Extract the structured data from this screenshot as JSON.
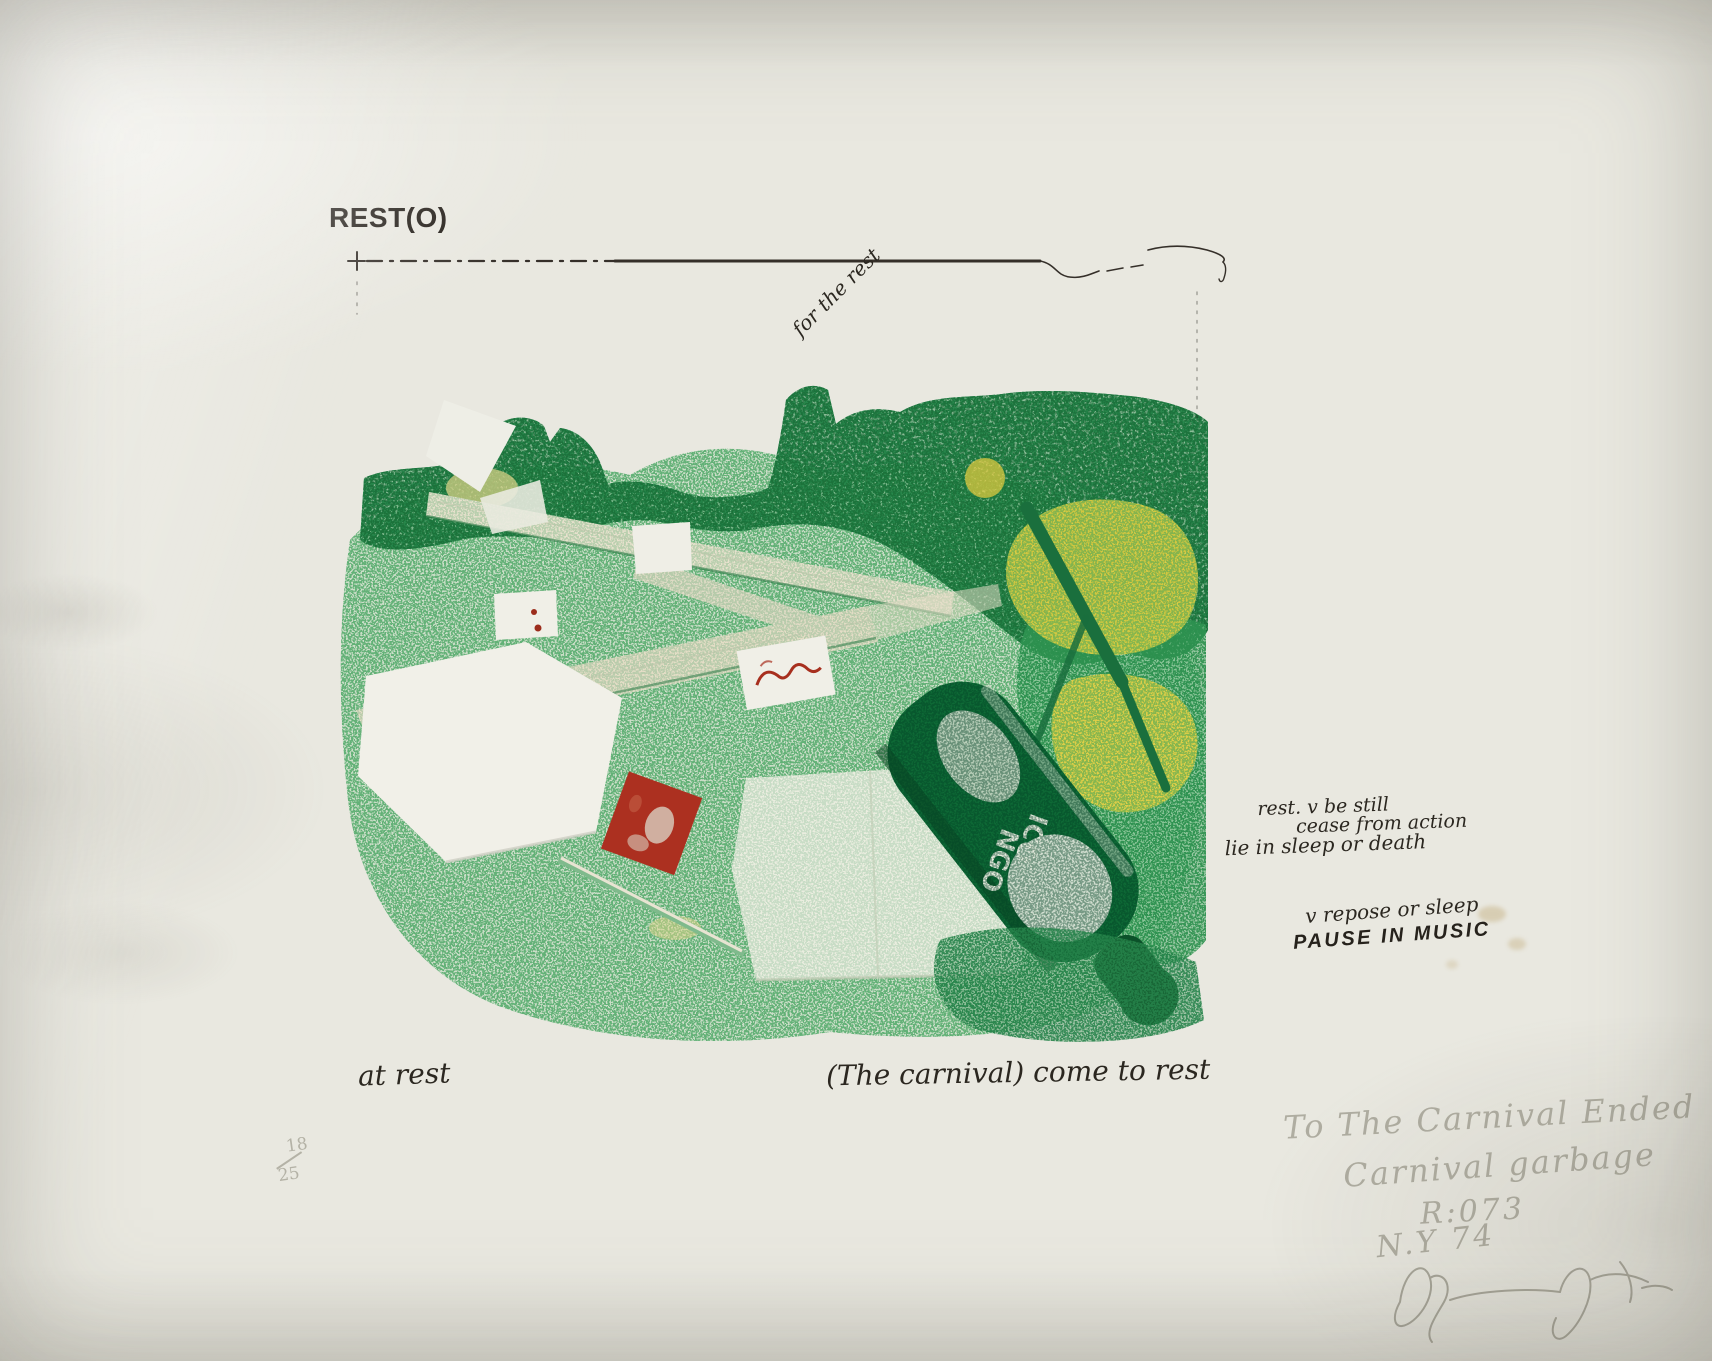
{
  "print": {
    "title": "REST(O)",
    "margin_note_top": "for the rest",
    "definition_note": {
      "line1": "rest. v be still",
      "line2": "cease from action",
      "line3": "lie in sleep or death"
    },
    "repose_note": {
      "line1": "v repose or sleep",
      "line2": "PAUSE IN MUSIC"
    },
    "caption_left": "at rest",
    "caption_center": "(The carnival) come to rest",
    "edition": {
      "numerator": "18",
      "denominator": "25"
    },
    "bottle_label": {
      "line1": "ICO",
      "line2": "NGO"
    },
    "pencil_inscription": {
      "line1": "To The Carnival Ended",
      "line2": "Carnival garbage",
      "line3": "R:073",
      "line4": "N.Y 74"
    },
    "colors": {
      "paper": "#e9e8e0",
      "ink": "#29251f",
      "pencil": "#a9a79b",
      "green_light": "#79bd8a",
      "green_mid": "#3aa05c",
      "green_dark": "#156f3a",
      "yellow": "#e9cf3e",
      "red": "#ab3121"
    }
  }
}
